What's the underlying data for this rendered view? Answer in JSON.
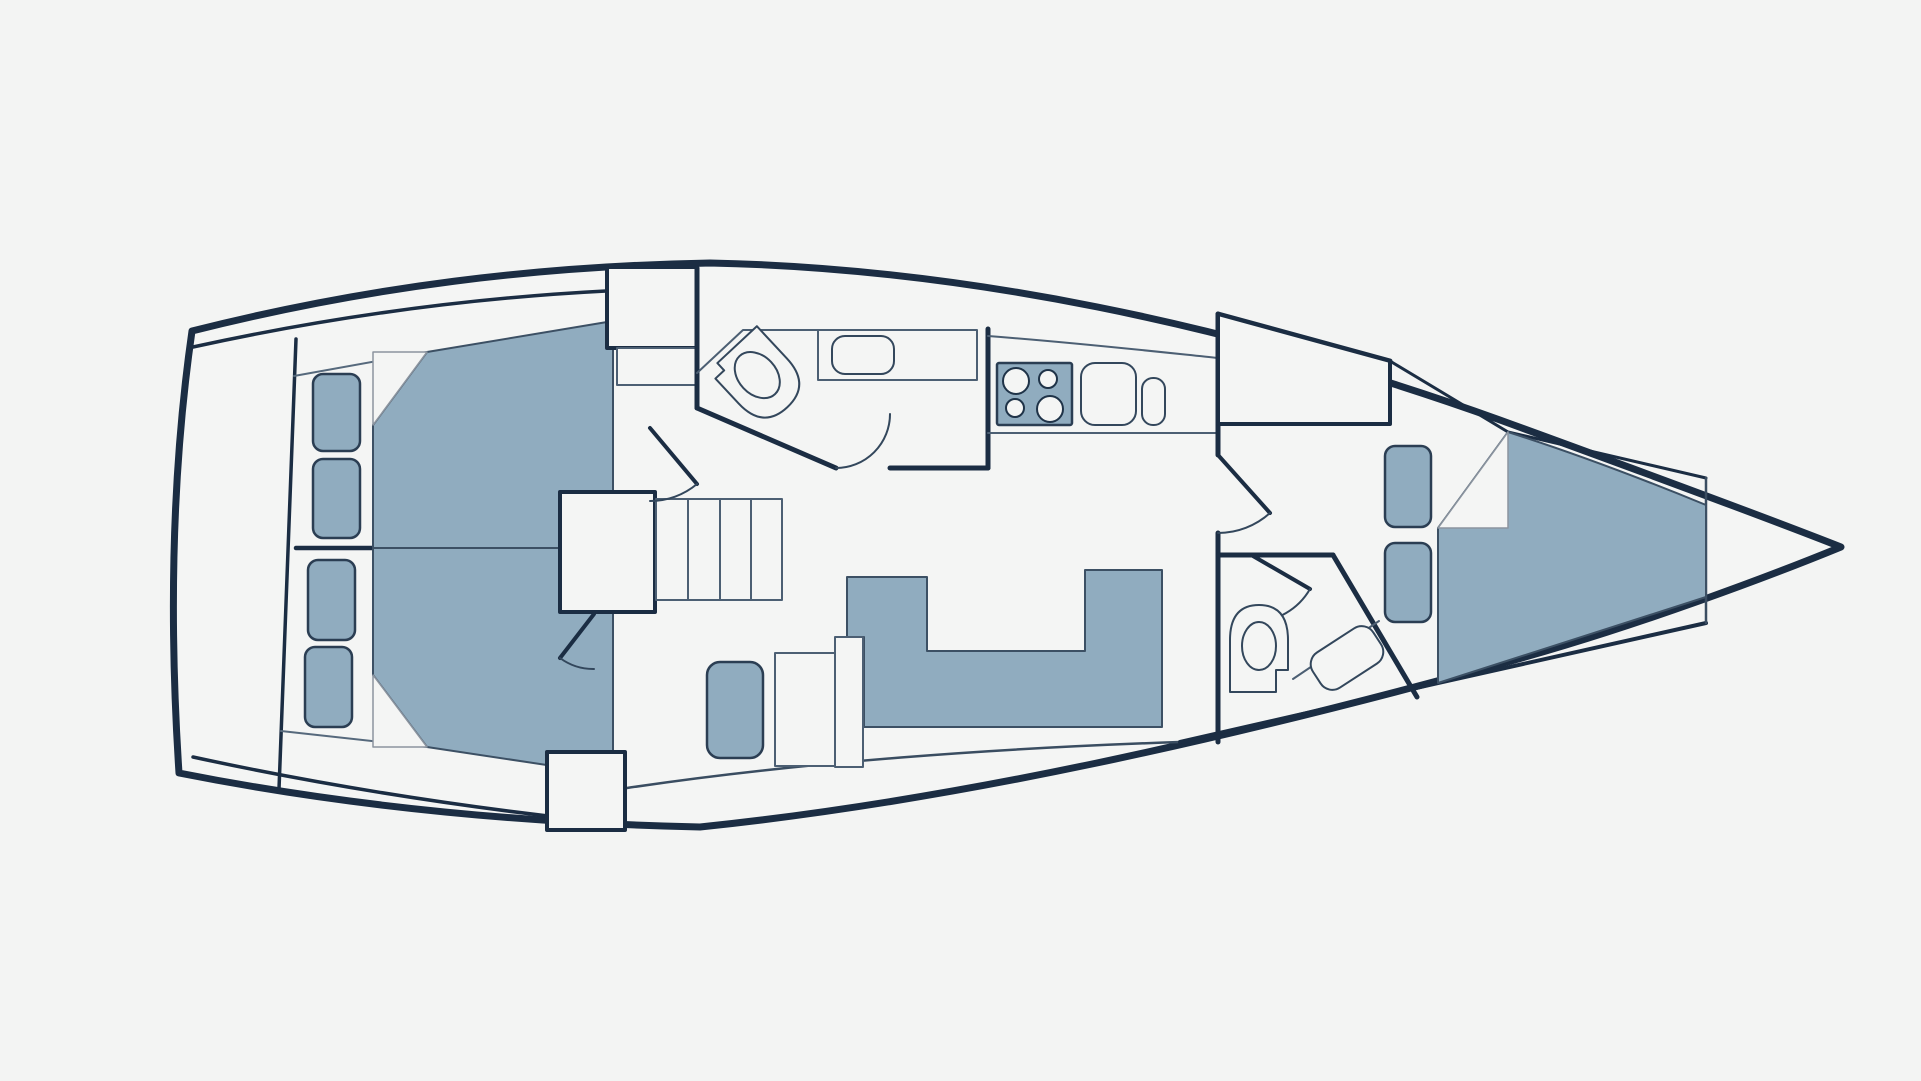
{
  "canvas": {
    "width": 1921,
    "height": 1081,
    "background": "#f3f4f3"
  },
  "palette": {
    "hull_line": "#1b2d43",
    "wall_line": "#1b2d43",
    "thin_line": "#4c5f73",
    "fold_line": "#8b949f",
    "furniture_fill": "#90acbf",
    "white_fill": "#f4f5f4",
    "cushion_stroke": "#2b3e53"
  },
  "diagram": {
    "type": "yacht-floor-plan",
    "elements": [
      {
        "name": "hull-outline",
        "kind": "path",
        "d": "M 192,331 C 370,286 540,266 710,263 C 960,268 1230,323 1500,420 C 1640,471 1780,523 1841,547 C 1780,572 1640,626 1500,664 C 1230,738 960,800 700,827 C 470,822 300,797 179,773 C 169,620 172,470 192,331 Z",
        "fill": "#f4f5f4",
        "stroke": "#1b2d43",
        "sw": 7
      },
      {
        "name": "deck-line-top",
        "kind": "path",
        "d": "M 193,347 C 330,317 470,298 606,291",
        "fill": "none",
        "stroke": "#1b2d43",
        "sw": 3.5
      },
      {
        "name": "deck-line-bottom",
        "kind": "path",
        "d": "M 193,757 C 340,789 480,809 600,822",
        "fill": "none",
        "stroke": "#1b2d43",
        "sw": 3.5
      },
      {
        "name": "stern-bulkhead",
        "kind": "path",
        "d": "M 296,339 L 279,789",
        "fill": "none",
        "stroke": "#1b2d43",
        "sw": 3.5
      },
      {
        "name": "platform-edge-top-aft",
        "kind": "path",
        "d": "M 294,376 L 427,352",
        "fill": "none",
        "stroke": "#56697c",
        "sw": 2
      },
      {
        "name": "platform-edge-bottom-aft",
        "kind": "path",
        "d": "M 281,731 L 427,747",
        "fill": "none",
        "stroke": "#56697c",
        "sw": 2
      },
      {
        "name": "inner-line-bottom-mid",
        "kind": "path",
        "d": "M 627,788 C 800,762 1000,748 1180,742",
        "fill": "none",
        "stroke": "#3a4d61",
        "sw": 2.5
      },
      {
        "name": "inner-line-bottom-forward",
        "kind": "path",
        "d": "M 1180,742 L 1438,683 L 1706,623",
        "fill": "none",
        "stroke": "#1b2d43",
        "sw": 4
      },
      {
        "name": "inner-line-top-forward-thick",
        "kind": "path",
        "d": "M 1218,314 L 1390,361",
        "fill": "none",
        "stroke": "#1b2d43",
        "sw": 5
      },
      {
        "name": "inner-line-top-forward",
        "kind": "path",
        "d": "M 1390,361 L 1508,432 L 1706,478",
        "fill": "none",
        "stroke": "#1b2d43",
        "sw": 3
      },
      {
        "name": "bow-bulkhead",
        "kind": "path",
        "d": "M 1706,478 L 1706,623",
        "fill": "none",
        "stroke": "#3a4d61",
        "sw": 2.5
      },
      {
        "name": "aft-cabin-divider",
        "kind": "path",
        "d": "M 296,548 L 562,548",
        "fill": "none",
        "stroke": "#1b2d43",
        "sw": 4.5
      },
      {
        "name": "bed-aft-upper",
        "kind": "path",
        "d": "M 427,352 L 613,321 L 613,548 L 373,548 L 373,425 Z",
        "fill": "#90acbf",
        "stroke": "#3c5064",
        "sw": 2
      },
      {
        "name": "bed-fold-aft-upper",
        "kind": "path",
        "d": "M 373,425 L 373,352 L 427,352 Z",
        "fill": "#f4f5f4",
        "stroke": "#8b949f",
        "sw": 1.5
      },
      {
        "name": "bed-aft-lower",
        "kind": "path",
        "d": "M 373,548 L 613,548 L 613,775 L 427,747 L 373,675 Z",
        "fill": "#90acbf",
        "stroke": "#3c5064",
        "sw": 2
      },
      {
        "name": "bed-fold-aft-lower",
        "kind": "path",
        "d": "M 373,675 L 427,747 L 373,747 Z",
        "fill": "#f4f5f4",
        "stroke": "#8b949f",
        "sw": 1.5
      },
      {
        "name": "locker-cushion-aft-1",
        "kind": "rect",
        "x": 313,
        "y": 374,
        "width": 47,
        "height": 77,
        "rx": 10,
        "fill": "#90acbf",
        "stroke": "#2b3e53",
        "sw": 2.5
      },
      {
        "name": "locker-cushion-aft-2",
        "kind": "rect",
        "x": 313,
        "y": 459,
        "width": 47,
        "height": 79,
        "rx": 10,
        "fill": "#90acbf",
        "stroke": "#2b3e53",
        "sw": 2.5
      },
      {
        "name": "locker-cushion-aft-3",
        "kind": "rect",
        "x": 308,
        "y": 560,
        "width": 47,
        "height": 80,
        "rx": 10,
        "fill": "#90acbf",
        "stroke": "#2b3e53",
        "sw": 2.5
      },
      {
        "name": "locker-cushion-aft-4",
        "kind": "rect",
        "x": 305,
        "y": 647,
        "width": 47,
        "height": 80,
        "rx": 10,
        "fill": "#90acbf",
        "stroke": "#2b3e53",
        "sw": 2.5
      },
      {
        "name": "wardrobe-aft",
        "kind": "rect",
        "x": 607,
        "y": 267,
        "width": 90,
        "height": 81,
        "rx": 0,
        "fill": "#f4f5f4",
        "stroke": "#1b2d43",
        "sw": 4
      },
      {
        "name": "locker-corridor",
        "kind": "rect",
        "x": 617,
        "y": 348,
        "width": 80,
        "height": 37,
        "rx": 0,
        "fill": "#f4f5f4",
        "stroke": "#4c5f73",
        "sw": 2
      },
      {
        "name": "companionway-landing",
        "kind": "rect",
        "x": 560,
        "y": 492,
        "width": 95,
        "height": 120,
        "rx": 0,
        "fill": "#f4f5f4",
        "stroke": "#1b2d43",
        "sw": 4
      },
      {
        "name": "stairs",
        "kind": "rect",
        "x": 656,
        "y": 499,
        "width": 126,
        "height": 101,
        "rx": 0,
        "fill": "#f4f5f4",
        "stroke": "#4c5f73",
        "sw": 2
      },
      {
        "name": "stair-risers",
        "kind": "path",
        "d": "M 688,499 L 688,600 M 720,499 L 720,600 M 751,499 L 751,600",
        "fill": "none",
        "stroke": "#4c5f73",
        "sw": 2
      },
      {
        "name": "companionway-block",
        "kind": "rect",
        "x": 547,
        "y": 752,
        "width": 78,
        "height": 78,
        "rx": 0,
        "fill": "#f4f5f4",
        "stroke": "#1b2d43",
        "sw": 4
      },
      {
        "name": "door-aft-cabin-upper-leaf",
        "kind": "path",
        "d": "M 650,428 L 697,484",
        "fill": "none",
        "stroke": "#1b2d43",
        "sw": 4
      },
      {
        "name": "door-aft-cabin-upper-arc",
        "kind": "path",
        "d": "M 697,484 A 73,73 0 0 1 650,501",
        "fill": "none",
        "stroke": "#33475c",
        "sw": 2
      },
      {
        "name": "door-aft-cabin-lower-leaf",
        "kind": "path",
        "d": "M 594,614 L 560,658",
        "fill": "none",
        "stroke": "#1b2d43",
        "sw": 4
      },
      {
        "name": "door-aft-cabin-lower-arc",
        "kind": "path",
        "d": "M 560,658 A 56,56 0 0 0 594,669",
        "fill": "none",
        "stroke": "#33475c",
        "sw": 2
      },
      {
        "name": "salon-sofa",
        "kind": "path",
        "d": "M 847,577 L 927,577 L 927,651 L 1085,651 L 1085,570 L 1162,570 L 1162,727 L 864,727 L 864,637 L 847,637 Z",
        "fill": "#90acbf",
        "stroke": "#3c5064",
        "sw": 2
      },
      {
        "name": "salon-table",
        "kind": "rect",
        "x": 775,
        "y": 653,
        "width": 63,
        "height": 113,
        "rx": 0,
        "fill": "#f4f5f4",
        "stroke": "#4c5f73",
        "sw": 2
      },
      {
        "name": "chart-table-strip",
        "kind": "rect",
        "x": 835,
        "y": 637,
        "width": 28,
        "height": 130,
        "rx": 0,
        "fill": "#f4f5f4",
        "stroke": "#4c5f73",
        "sw": 2
      },
      {
        "name": "salon-seat",
        "kind": "rect",
        "x": 707,
        "y": 662,
        "width": 56,
        "height": 96,
        "rx": 13,
        "fill": "#90acbf",
        "stroke": "#2b3e53",
        "sw": 2.5
      },
      {
        "name": "aft-head-wall-left",
        "kind": "path",
        "d": "M 697,268 L 697,408",
        "fill": "none",
        "stroke": "#1b2d43",
        "sw": 5
      },
      {
        "name": "aft-head-door-leaf",
        "kind": "path",
        "d": "M 697,408 L 836,468",
        "fill": "none",
        "stroke": "#1b2d43",
        "sw": 5
      },
      {
        "name": "aft-head-door-arc",
        "kind": "path",
        "d": "M 836,468 A 54,54 0 0 0 890,414",
        "fill": "none",
        "stroke": "#33475c",
        "sw": 2
      },
      {
        "name": "aft-head-wall-bottom",
        "kind": "path",
        "d": "M 890,468 L 988,468",
        "fill": "none",
        "stroke": "#1b2d43",
        "sw": 5
      },
      {
        "name": "aft-head-wall-right",
        "kind": "path",
        "d": "M 988,468 L 988,329",
        "fill": "none",
        "stroke": "#1b2d43",
        "sw": 5
      },
      {
        "name": "aft-head-platform-line",
        "kind": "path",
        "d": "M 697,373 L 743,330 L 818,330",
        "fill": "none",
        "stroke": "#4c5f73",
        "sw": 2
      },
      {
        "name": "aft-head-vanity",
        "kind": "rect",
        "x": 818,
        "y": 330,
        "width": 159,
        "height": 50,
        "rx": 0,
        "fill": "#f4f5f4",
        "stroke": "#4c5f73",
        "sw": 2
      },
      {
        "name": "aft-head-sink",
        "kind": "rect",
        "x": 832,
        "y": 336,
        "width": 62,
        "height": 38,
        "rx": 13,
        "fill": "#f4f5f4",
        "stroke": "#33475c",
        "sw": 2
      },
      {
        "name": "aft-head-toilet-body",
        "kind": "path",
        "d": "M -33,40 L -33,-4 Q -33,-40 0,-40 Q 33,-40 33,-4 L 33,30 L 21,30 L 21,40 Z",
        "transform": "translate(760,378) rotate(137)",
        "fill": "#f4f5f4",
        "stroke": "#33475c",
        "sw": 2
      },
      {
        "name": "aft-head-toilet-bowl",
        "kind": "ellipse",
        "cx": 0,
        "cy": 4,
        "rx": 19,
        "ry": 26,
        "transform": "translate(760,378) rotate(137)",
        "fill": "#f4f5f4",
        "stroke": "#33475c",
        "sw": 2
      },
      {
        "name": "galley-counter-top-line",
        "kind": "path",
        "d": "M 988,336 C 1080,343 1160,352 1218,358",
        "fill": "none",
        "stroke": "#4c5f73",
        "sw": 2
      },
      {
        "name": "galley-counter-bottom-line",
        "kind": "path",
        "d": "M 988,433 L 1218,433",
        "fill": "none",
        "stroke": "#4c5f73",
        "sw": 2
      },
      {
        "name": "galley-stove",
        "kind": "rect",
        "x": 997,
        "y": 363,
        "width": 75,
        "height": 62,
        "rx": 2,
        "fill": "#90acbf",
        "stroke": "#2b3e53",
        "sw": 2.5
      },
      {
        "name": "stove-burner-1",
        "kind": "circle",
        "cx": 1016,
        "cy": 381,
        "r": 13,
        "fill": "#f4f5f4",
        "stroke": "#1f3348",
        "sw": 2
      },
      {
        "name": "stove-burner-2",
        "kind": "circle",
        "cx": 1048,
        "cy": 379,
        "r": 9,
        "fill": "#f4f5f4",
        "stroke": "#1f3348",
        "sw": 2
      },
      {
        "name": "stove-burner-3",
        "kind": "circle",
        "cx": 1015,
        "cy": 408,
        "r": 9,
        "fill": "#f4f5f4",
        "stroke": "#1f3348",
        "sw": 2
      },
      {
        "name": "stove-burner-4",
        "kind": "circle",
        "cx": 1050,
        "cy": 409,
        "r": 13,
        "fill": "#f4f5f4",
        "stroke": "#1f3348",
        "sw": 2
      },
      {
        "name": "galley-sink",
        "kind": "rect",
        "x": 1081,
        "y": 363,
        "width": 55,
        "height": 62,
        "rx": 14,
        "fill": "#f4f5f4",
        "stroke": "#33475c",
        "sw": 2
      },
      {
        "name": "galley-faucet",
        "kind": "rect",
        "x": 1142,
        "y": 378,
        "width": 23,
        "height": 47,
        "rx": 11,
        "fill": "#f4f5f4",
        "stroke": "#33475c",
        "sw": 2
      },
      {
        "name": "main-bulkhead-upper",
        "kind": "path",
        "d": "M 1218,314 L 1218,455",
        "fill": "none",
        "stroke": "#1b2d43",
        "sw": 5
      },
      {
        "name": "main-bulkhead-lower",
        "kind": "path",
        "d": "M 1218,533 L 1218,742",
        "fill": "none",
        "stroke": "#1b2d43",
        "sw": 5
      },
      {
        "name": "door-forward-cabin-leaf",
        "kind": "path",
        "d": "M 1218,455 L 1270,513",
        "fill": "none",
        "stroke": "#1b2d43",
        "sw": 4
      },
      {
        "name": "door-forward-cabin-arc",
        "kind": "path",
        "d": "M 1270,513 A 78,78 0 0 1 1218,533",
        "fill": "none",
        "stroke": "#33475c",
        "sw": 2
      },
      {
        "name": "wardrobe-forward",
        "kind": "path",
        "d": "M 1218,314 L 1390,361 L 1390,424 L 1218,424 Z",
        "fill": "#f4f5f4",
        "stroke": "#1b2d43",
        "sw": 4
      },
      {
        "name": "forward-head-wall-top",
        "kind": "path",
        "d": "M 1218,555 L 1333,555",
        "fill": "none",
        "stroke": "#1b2d43",
        "sw": 5
      },
      {
        "name": "forward-head-wall-diagonal",
        "kind": "path",
        "d": "M 1333,555 L 1417,697",
        "fill": "none",
        "stroke": "#1b2d43",
        "sw": 5
      },
      {
        "name": "door-forward-head-leaf",
        "kind": "path",
        "d": "M 1253,556 L 1310,589",
        "fill": "none",
        "stroke": "#1b2d43",
        "sw": 4
      },
      {
        "name": "door-forward-head-arc",
        "kind": "path",
        "d": "M 1310,589 A 66,66 0 0 1 1253,622",
        "fill": "none",
        "stroke": "#33475c",
        "sw": 2
      },
      {
        "name": "forward-head-toilet-body",
        "kind": "path",
        "d": "M -29,44 L -29,-8 Q -29,-43 0,-43 Q 29,-43 29,-8 L 29,22 L 17,22 L 17,44 Z",
        "transform": "translate(1259,648)",
        "fill": "#f4f5f4",
        "stroke": "#33475c",
        "sw": 2
      },
      {
        "name": "forward-head-toilet-bowl",
        "kind": "ellipse",
        "cx": 0,
        "cy": -2,
        "rx": 17,
        "ry": 24,
        "transform": "translate(1259,648)",
        "fill": "#f4f5f4",
        "stroke": "#33475c",
        "sw": 2
      },
      {
        "name": "forward-head-counter-line",
        "kind": "path",
        "d": "M 1293,679 L 1379,621",
        "fill": "none",
        "stroke": "#4c5f73",
        "sw": 2
      },
      {
        "name": "forward-head-sink",
        "kind": "rect",
        "x": -36,
        "y": -21,
        "width": 72,
        "height": 42,
        "rx": 14,
        "transform": "translate(1347,658) rotate(-33)",
        "fill": "#f4f5f4",
        "stroke": "#33475c",
        "sw": 2
      },
      {
        "name": "locker-cushion-forward-1",
        "kind": "rect",
        "x": 1385,
        "y": 446,
        "width": 46,
        "height": 81,
        "rx": 10,
        "fill": "#90acbf",
        "stroke": "#2b3e53",
        "sw": 2.5
      },
      {
        "name": "locker-cushion-forward-2",
        "kind": "rect",
        "x": 1385,
        "y": 543,
        "width": 46,
        "height": 79,
        "rx": 10,
        "fill": "#90acbf",
        "stroke": "#2b3e53",
        "sw": 2.5
      },
      {
        "name": "bed-forward-vberth",
        "kind": "path",
        "d": "M 1508,432 C 1580,455 1650,482 1706,505 L 1706,597 L 1438,683 L 1438,528 Z",
        "fill": "#90acbf",
        "stroke": "#3c5064",
        "sw": 2
      },
      {
        "name": "bed-fold-forward",
        "kind": "path",
        "d": "M 1438,528 L 1508,432 L 1508,528 Z",
        "fill": "#f4f5f4",
        "stroke": "#8b949f",
        "sw": 1.5
      }
    ]
  }
}
